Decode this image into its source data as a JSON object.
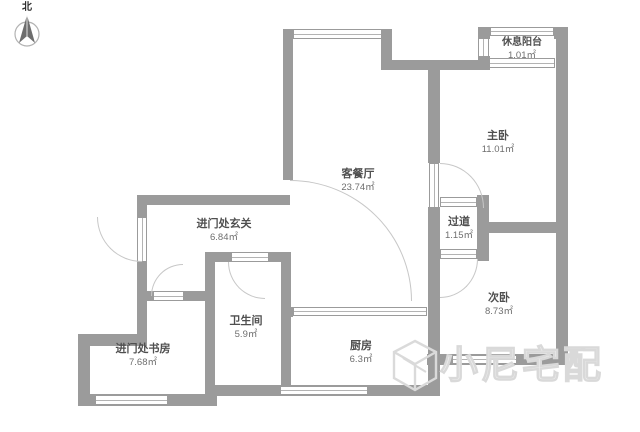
{
  "compass": {
    "north_label": "北"
  },
  "rooms": [
    {
      "id": "living-dining",
      "name": "客餐厅",
      "area": "23.74㎡"
    },
    {
      "id": "rest-balcony",
      "name": "休息阳台",
      "area": "1.01㎡"
    },
    {
      "id": "master-bedroom",
      "name": "主卧",
      "area": "11.01㎡"
    },
    {
      "id": "hallway",
      "name": "过道",
      "area": "1.15㎡"
    },
    {
      "id": "second-bedroom",
      "name": "次卧",
      "area": "8.73㎡"
    },
    {
      "id": "entry-foyer",
      "name": "进门处玄关",
      "area": "6.84㎡"
    },
    {
      "id": "bathroom",
      "name": "卫生间",
      "area": "5.9㎡"
    },
    {
      "id": "kitchen",
      "name": "厨房",
      "area": "6.3㎡"
    },
    {
      "id": "entry-study",
      "name": "进门处书房",
      "area": "7.68㎡"
    }
  ],
  "watermark": {
    "logo": "N",
    "text": "小尼宅配"
  },
  "colors": {
    "wall": "#9b9b9b",
    "window_line": "#b3b3b3",
    "door_arc": "#c7c7c7",
    "room_name_text": "#4f4f4f",
    "room_area_text": "#6e6e6e",
    "watermark": "#d9d9d9"
  }
}
